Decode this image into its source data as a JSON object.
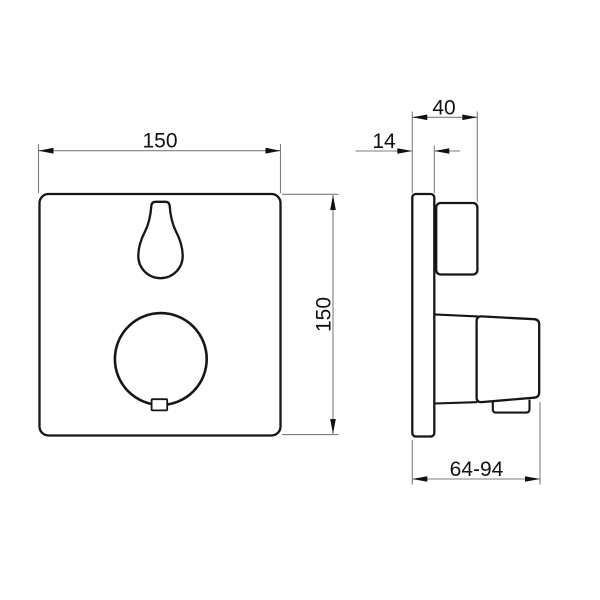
{
  "dimensions": {
    "front_width": "150",
    "front_height": "150",
    "total_depth": "40",
    "plate_thickness": "14",
    "installation_depth": "64-94"
  },
  "colors": {
    "background": "#ffffff",
    "outline": "#161616",
    "dimension_line": "#7e7e7e",
    "text": "#111111"
  }
}
